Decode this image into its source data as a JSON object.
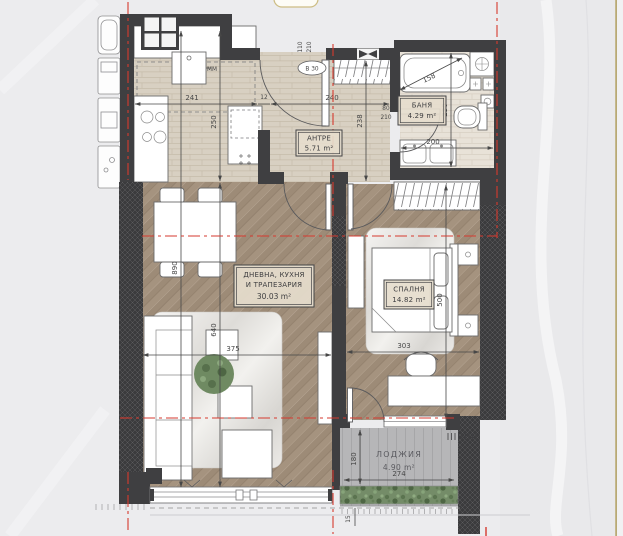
{
  "rooms": {
    "hall": {
      "name": "АНТРЕ",
      "area": "5.71 m²"
    },
    "bath": {
      "name": "БАНЯ",
      "area": "4.29 m²"
    },
    "living": {
      "line1": "ДНЕВНА, КУХНЯ",
      "line2": "И ТРАПЕЗАРИЯ",
      "area": "30.03 m²"
    },
    "bedroom": {
      "name": "СПАЛНЯ",
      "area": "14.82 m²"
    },
    "loggia": {
      "name": "ЛОДЖИЯ",
      "area": "4.90 m²"
    }
  },
  "dims": {
    "kitchen_w": "241",
    "partition": "12",
    "hall_w": "240",
    "kitchen_d": "250",
    "hall_d": "238",
    "entry_w": "110",
    "entry_h": "210",
    "bathdoor_w": "80",
    "bathdoor_h": "210",
    "tub_l": "158",
    "bath_d": "230",
    "bath_w": "200",
    "total_d": "890",
    "living_d": "640",
    "living_w": "375",
    "bedroom_d": "500",
    "bedroom_w": "303",
    "loggia_d": "180",
    "loggia_w": "274",
    "parapet": "15"
  },
  "badges": {
    "entry_door": "В 30",
    "appliance": "ММ"
  },
  "colors": {
    "wall": "#3f3f41",
    "axis_red": "#d63a2f",
    "gold_line": "#b3a266",
    "tile": "#d8d0c2",
    "bath_tile": "#e8e2d8",
    "wood": "#a5937f",
    "loggia_floor": "#b6b6b8",
    "greenery": "#748c68",
    "label_bg": "#e5ddcc",
    "background": "#ececee"
  }
}
